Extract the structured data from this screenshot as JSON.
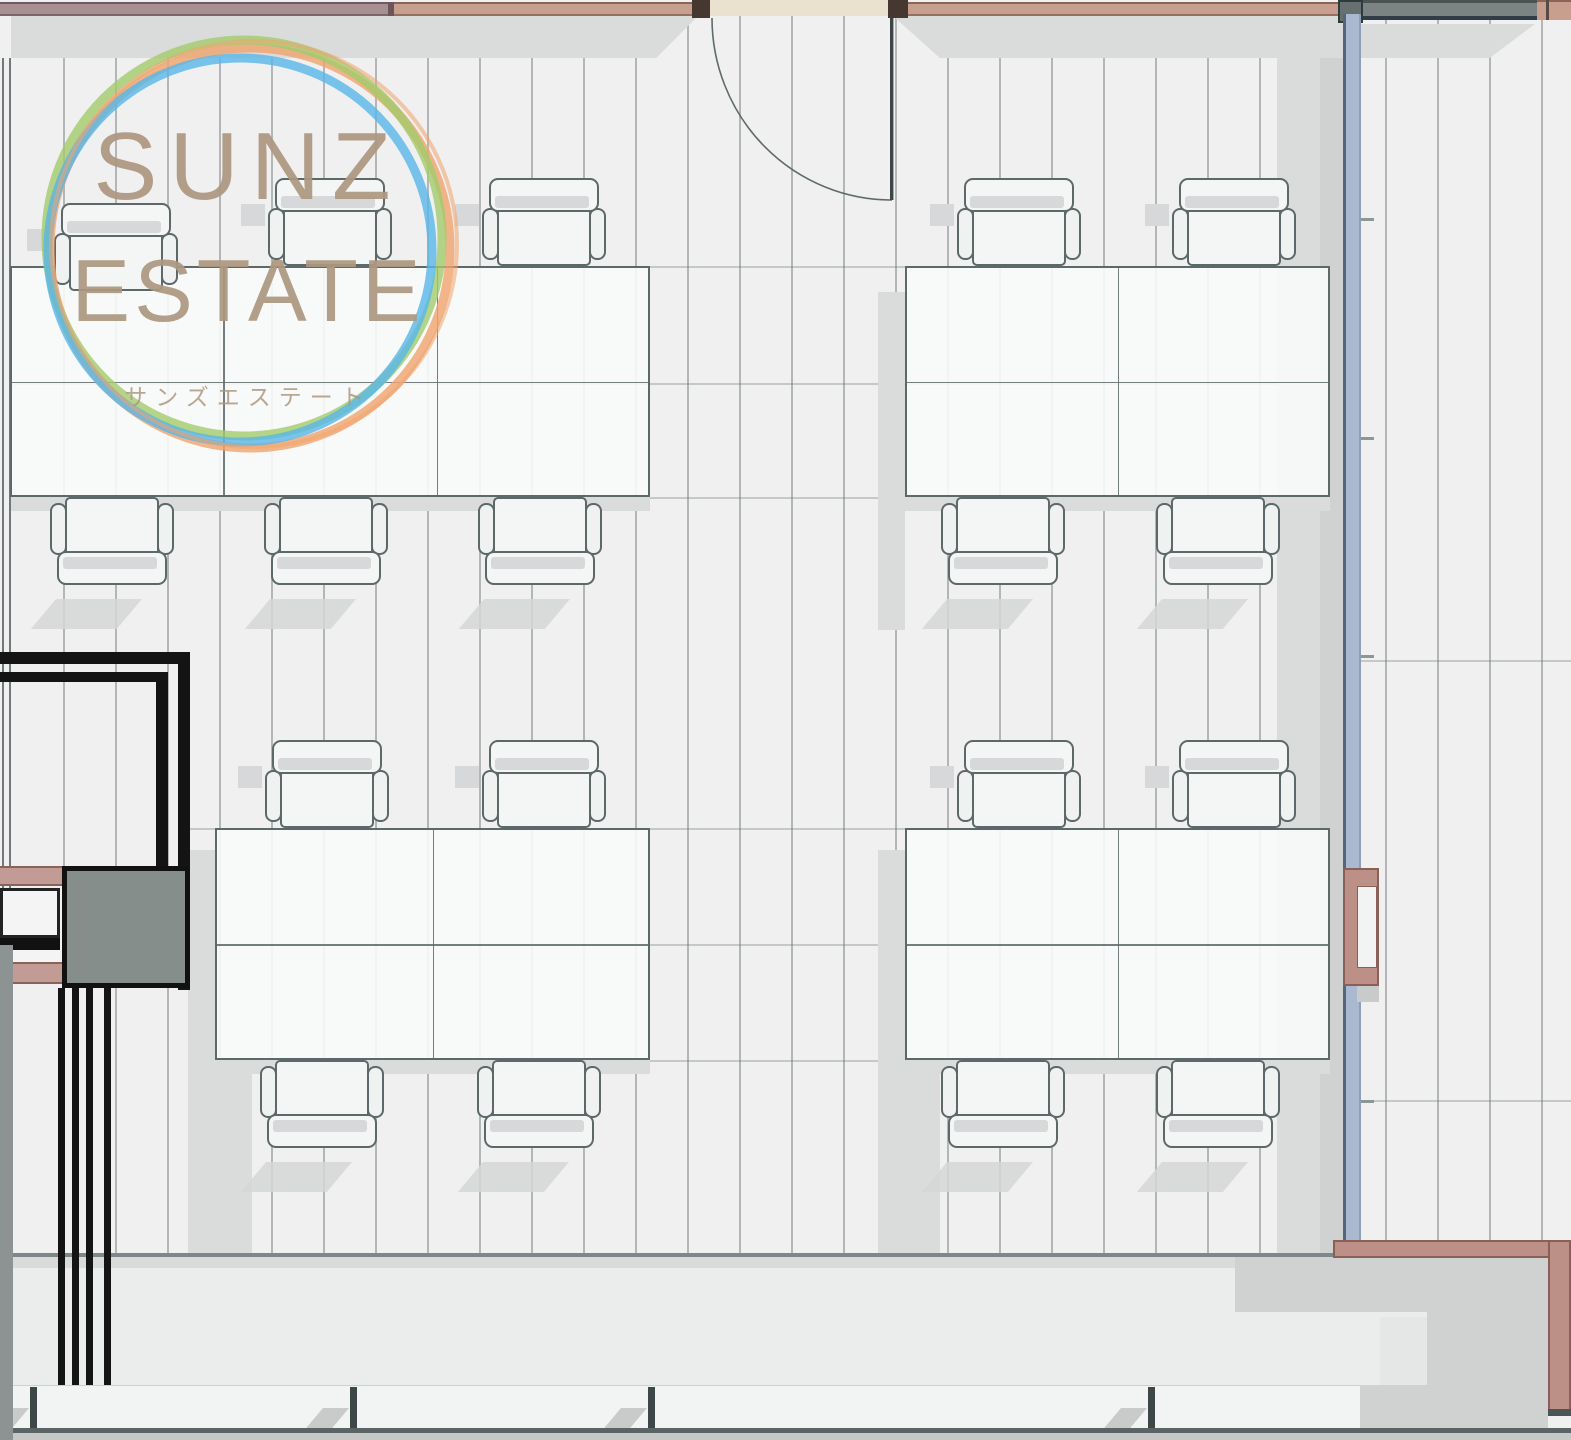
{
  "meta": {
    "title": "Office floor plan with SUNZ ESTATE watermark"
  },
  "logo": {
    "line1": "SUNZ",
    "line2": "ESTATE",
    "subtitle": "サンズエステート",
    "ring_colors": {
      "green": "#a2cb6b",
      "blue": "#58b7e8",
      "orange": "#f0a46e"
    },
    "text_color": "#ad9880"
  },
  "palette": {
    "floor": "#f0f0f1",
    "plank_line": "#a3a8a9",
    "joint_line": "rgba(100,110,110,0.30)",
    "shadow": "#dadcdc",
    "shadow_dark": "#d0d2d2",
    "shadow_soft": "#e5e6e6",
    "desk_fill": "rgba(248,249,250,0.9)",
    "desk_border": "#5d6868",
    "chair_fill": "#f4f5f5",
    "chair_border": "#5d6868",
    "chair_gray": "#d7d8d9",
    "chair_shadow": "#d5d7d7",
    "wall_mauve": "#a78f92",
    "wall_mauve_edge": "#7c666b",
    "wall_salmon": "#c89e8e",
    "wall_salmon_edge": "#8a6458",
    "doorway_cream": "#eae1cf",
    "jamb": "#463831",
    "wall_darkgray": "#7b8383",
    "wall_darkgray_edge": "#2e3d47",
    "wall_blue": "#aab9d0",
    "wall_blue_edge": "#55657a",
    "wall_coral": "#bd9087",
    "wall_coral_edge": "#8a5f57",
    "shaft_black": "#141414",
    "box_gray": "#868e8c",
    "band_pink": "#c39b95",
    "left_wall": "#8d9392",
    "walkway": "#ebedec",
    "walkway_band": "#d9dbda",
    "step": "#f2f3f3",
    "edge_line": "#7e8888",
    "bottom_line": "#5a6464",
    "bottom_band": "#c6c8c7",
    "tick": "#3d4747",
    "logo_text": "#ad9880"
  },
  "floor": {
    "sections": [
      {
        "name": "floor-left-room",
        "x": 11,
        "y": 14,
        "w": 1332,
        "h": 1248,
        "first": 52,
        "step": 52
      },
      {
        "name": "floor-right-room",
        "x": 1361,
        "y": 20,
        "w": 210,
        "h": 1222,
        "first": 24,
        "step": 52
      }
    ],
    "joints": [
      {
        "x": 11,
        "y": 266,
        "w": 1332
      },
      {
        "x": 11,
        "y": 383,
        "w": 1332
      },
      {
        "x": 11,
        "y": 497,
        "w": 1332
      },
      {
        "x": 188,
        "y": 828,
        "w": 1155
      },
      {
        "x": 188,
        "y": 944,
        "w": 1155
      },
      {
        "x": 188,
        "y": 1060,
        "w": 1155
      },
      {
        "x": 1361,
        "y": 660,
        "w": 210
      },
      {
        "x": 1361,
        "y": 1100,
        "w": 210
      }
    ]
  },
  "shadows": [
    {
      "n": "wall-shadow-left-of-door",
      "x": 11,
      "y": 16,
      "w": 687,
      "h": 42,
      "clip": "polygon(0 0,100% 0,93.9% 100%,0 100%)"
    },
    {
      "n": "wall-shadow-right-of-door",
      "x": 893,
      "y": 16,
      "w": 450,
      "h": 42,
      "clip": "polygon(0 0,100% 0,100% 100%,10.4% 100%)"
    },
    {
      "n": "wall-shadow-right-room",
      "x": 1361,
      "y": 24,
      "w": 174,
      "h": 34,
      "clip": "polygon(0 0,100% 0,74% 100%,0 100%)"
    },
    {
      "n": "blue-wall-shadow-band",
      "x": 1277,
      "y": 58,
      "w": 66,
      "h": 1196
    },
    {
      "n": "blue-wall-shadow-band-dark",
      "x": 1320,
      "y": 58,
      "w": 23,
      "h": 1196,
      "c": "shadow_dark"
    },
    {
      "n": "cluster-side-shadow",
      "x": 878,
      "y": 292,
      "w": 27,
      "h": 338
    },
    {
      "n": "cluster-side-shadow",
      "x": 878,
      "y": 850,
      "w": 27,
      "h": 330
    },
    {
      "n": "cluster-side-shadow",
      "x": 188,
      "y": 850,
      "w": 27,
      "h": 330
    },
    {
      "n": "cluster-bottom-shadow",
      "x": 10,
      "y": 497,
      "w": 640,
      "h": 14
    },
    {
      "n": "cluster-bottom-shadow",
      "x": 905,
      "y": 497,
      "w": 425,
      "h": 14
    },
    {
      "n": "cluster-bottom-shadow",
      "x": 215,
      "y": 1060,
      "w": 435,
      "h": 14
    },
    {
      "n": "cluster-bottom-shadow",
      "x": 905,
      "y": 1060,
      "w": 425,
      "h": 14
    },
    {
      "n": "cluster-floor-shadow",
      "x": 188,
      "y": 1074,
      "w": 64,
      "h": 180
    },
    {
      "n": "cluster-floor-shadow",
      "x": 878,
      "y": 1074,
      "w": 62,
      "h": 180
    }
  ],
  "furniture": {
    "chair": {
      "w": 124,
      "h": 88,
      "backrest_w": 110,
      "backrest_h": 34,
      "seat_w": 94,
      "seat_h": 68,
      "arm_w": 17,
      "arm_h": 52
    },
    "desk_clusters": [
      {
        "name": "desk-cluster-top-left",
        "x": 10,
        "y": 266,
        "cols": 3,
        "rows": 2,
        "col_w": 213.3,
        "row_h": 115.5,
        "chairs_top": [
          {
            "cx": 116,
            "dy": 25
          },
          {
            "cx": 330
          },
          {
            "cx": 544
          }
        ],
        "chairs_bottom": [
          {
            "cx": 112
          },
          {
            "cx": 326
          },
          {
            "cx": 540
          }
        ]
      },
      {
        "name": "desk-cluster-top-right",
        "x": 905,
        "y": 266,
        "cols": 2,
        "rows": 2,
        "col_w": 212.5,
        "row_h": 115.5,
        "chairs_top": [
          {
            "cx": 1019
          },
          {
            "cx": 1234
          }
        ],
        "chairs_bottom": [
          {
            "cx": 1003
          },
          {
            "cx": 1218
          }
        ]
      },
      {
        "name": "desk-cluster-mid-left",
        "x": 215,
        "y": 828,
        "cols": 2,
        "rows": 2,
        "col_w": 217.5,
        "row_h": 116,
        "chairs_top": [
          {
            "cx": 327
          },
          {
            "cx": 544
          }
        ],
        "chairs_bottom": [
          {
            "cx": 322
          },
          {
            "cx": 539
          }
        ]
      },
      {
        "name": "desk-cluster-mid-right",
        "x": 905,
        "y": 828,
        "cols": 2,
        "rows": 2,
        "col_w": 212.5,
        "row_h": 116,
        "chairs_top": [
          {
            "cx": 1019
          },
          {
            "cx": 1234
          }
        ],
        "chairs_bottom": [
          {
            "cx": 1003
          },
          {
            "cx": 1218
          }
        ]
      }
    ]
  },
  "wall_ticks": [
    218,
    437,
    655,
    1100
  ],
  "step_ticks": [
    30,
    350,
    648,
    1148
  ],
  "walkway_shadows": [
    {
      "x": 1235,
      "y": 1257,
      "w": 313,
      "h": 55
    },
    {
      "x": 1427,
      "y": 1268,
      "w": 121,
      "h": 117
    },
    {
      "x": 1380,
      "y": 1317,
      "w": 47,
      "h": 68,
      "c": "shadow_soft"
    },
    {
      "x": 1360,
      "y": 1385,
      "w": 188,
      "h": 43
    }
  ]
}
